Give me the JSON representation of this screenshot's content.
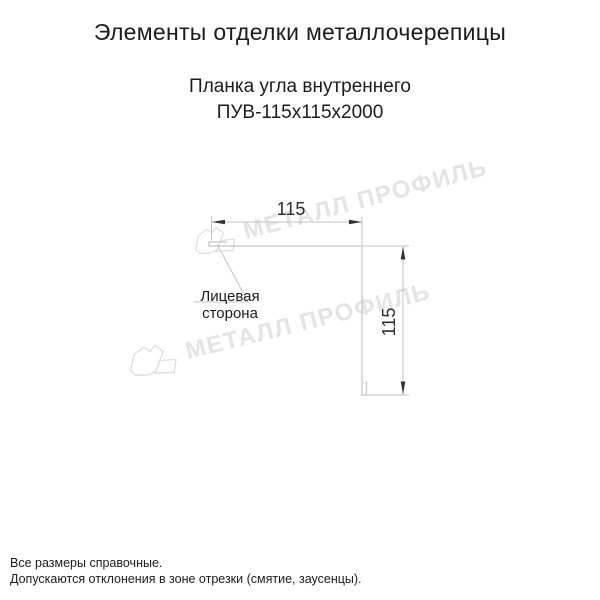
{
  "header": {
    "title": "Элементы отделки металлочерепицы"
  },
  "product": {
    "name": "Планка угла внутреннего",
    "code": "ПУВ-115х115х2000"
  },
  "diagram": {
    "type": "technical-drawing",
    "width_label": "115",
    "height_label": "115",
    "face_side_label": "Лицевая сторона"
  },
  "watermark": {
    "text": "МЕТАЛЛ ПРОФИЛЬ",
    "color": "#e4e4e4"
  },
  "footer": {
    "line1": "Все размеры справочные.",
    "line2": "Допускаются отклонения в зоне отрезки (смятие, заусенцы)."
  },
  "colors": {
    "background": "#ffffff",
    "text": "#1c1c1c",
    "line": "#c3c3c3",
    "arrow": "#333333"
  }
}
